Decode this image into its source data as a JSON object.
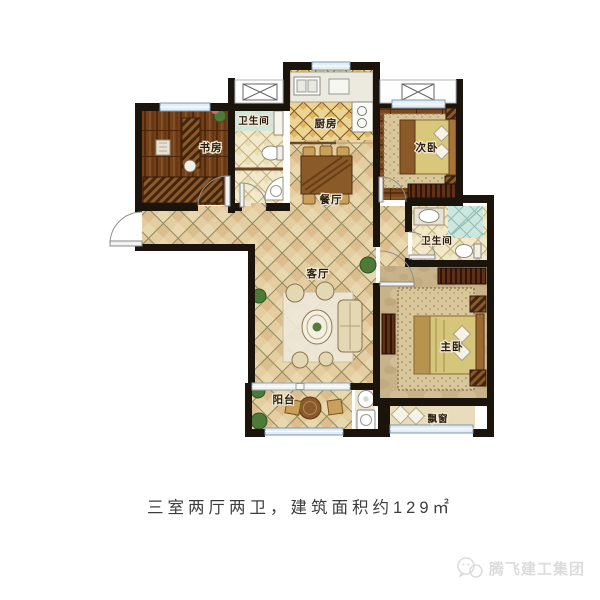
{
  "rooms": {
    "study": "书房",
    "bath1": "卫生间",
    "kitchen": "厨房",
    "bedroom2": "次卧",
    "dining": "餐厅",
    "living": "客厅",
    "bath2": "卫生间",
    "master": "主卧",
    "balcony": "阳台",
    "bay_window": "飘窗"
  },
  "caption": "三室两厅两卫，建筑面积约129㎡",
  "watermark": {
    "name": "腾飞建工集团"
  },
  "colors": {
    "wall": "#1a140d",
    "tile_base": "#e3cda1",
    "kitchen_tile": "#ecd493",
    "bath_tile": "#f2e9ca",
    "shower_teal": "#cde7df",
    "wood_floor": "#73401a",
    "master_floor": "#c8b28a",
    "window_fill": "#e2edf5",
    "caption_text": "#3d3d3d",
    "watermark_gray": "#dcdcdc"
  }
}
